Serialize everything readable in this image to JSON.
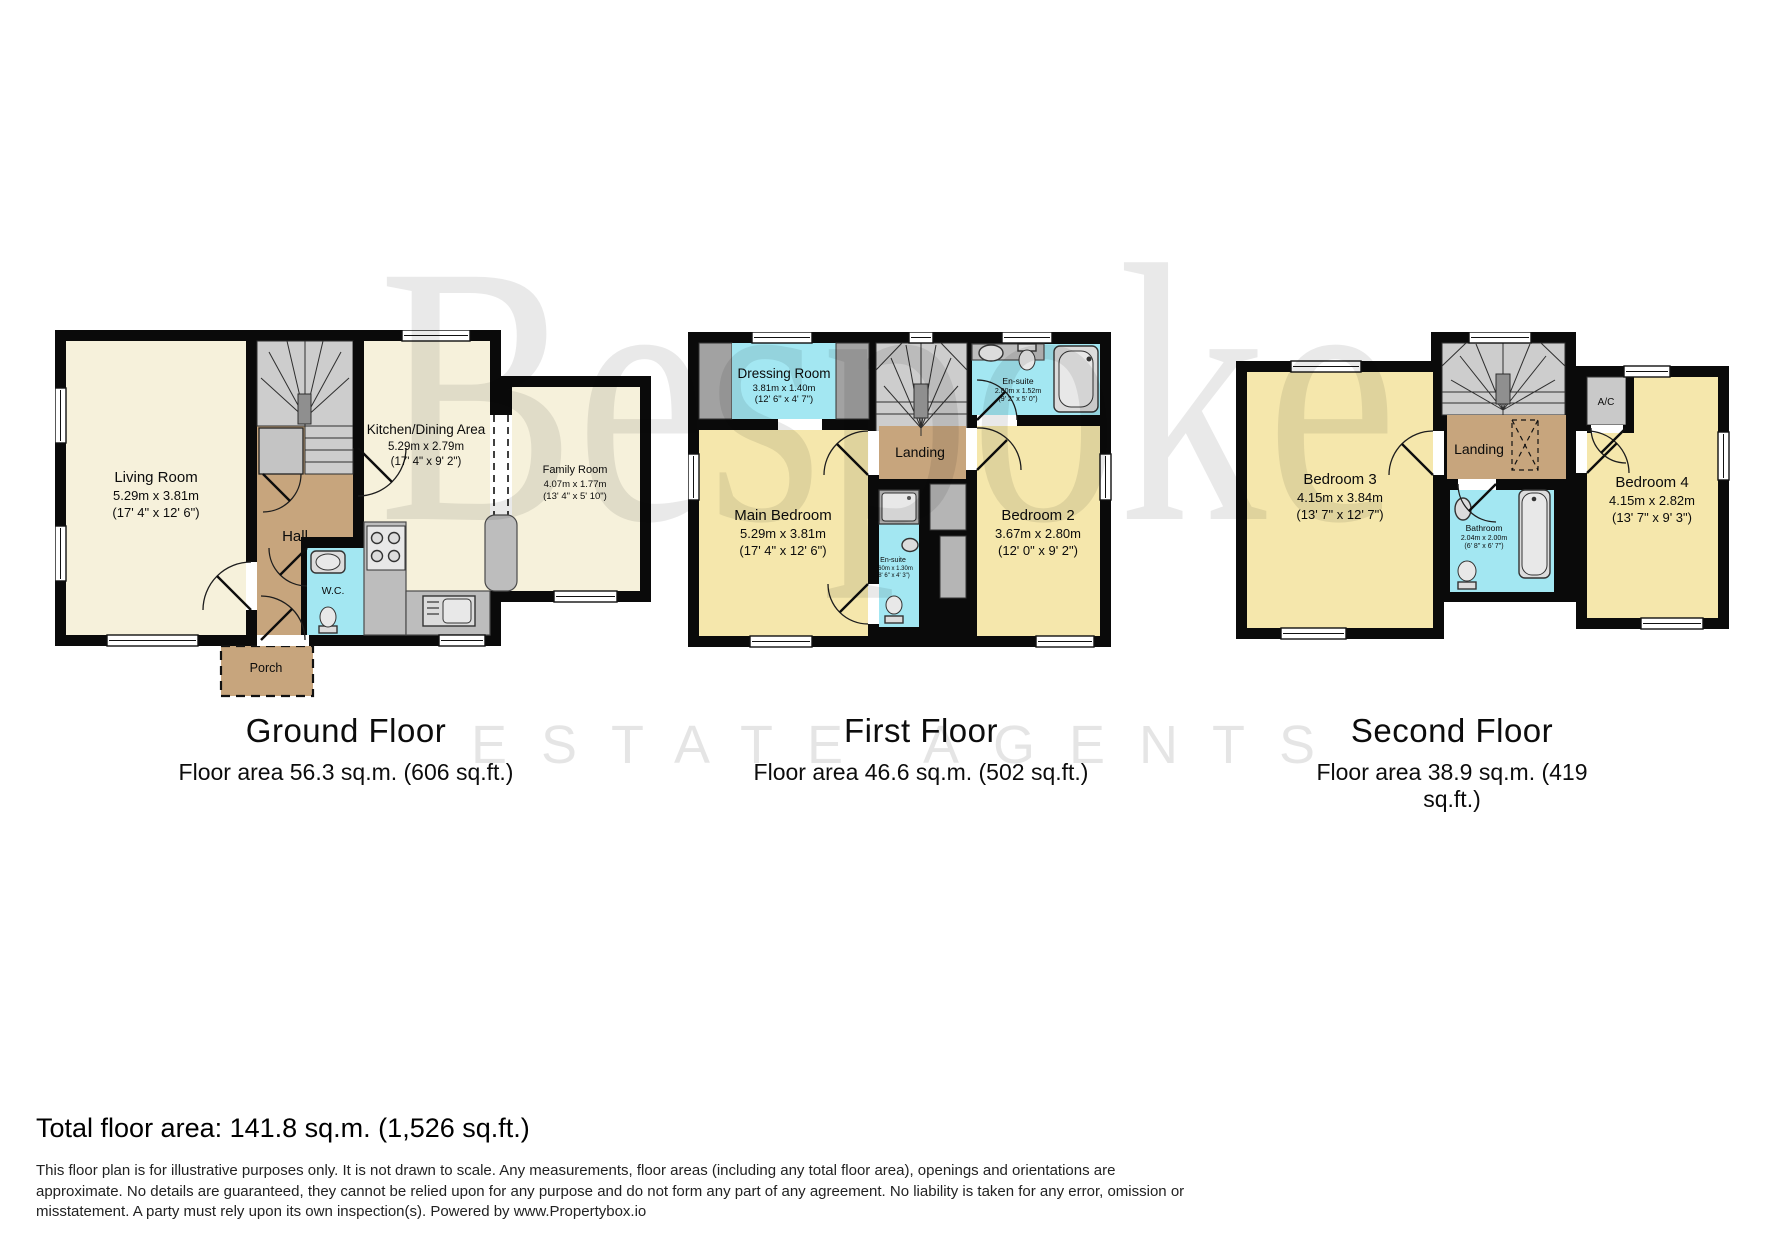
{
  "watermark": {
    "brand": "Bespoke",
    "tagline": "ESTATE AGENTS"
  },
  "colors": {
    "wall_black": "#0a0a0a",
    "room_cream": "#F6F1DB",
    "room_yellow": "#F5E7AC",
    "wet_cyan": "#A3E7F2",
    "circulation_tan": "#C7A57D",
    "stairs_gray": "#CDCDCD"
  },
  "floors": {
    "ground": {
      "title": "Ground Floor",
      "area_label": "Floor area 56.3 sq.m. (606 sq.ft.)",
      "rooms": {
        "living_room": {
          "name": "Living Room",
          "metric": "5.29m x 3.81m",
          "imperial": "(17' 4\" x 12' 6\")"
        },
        "kitchen_dining": {
          "name": "Kitchen/Dining Area",
          "metric": "5.29m x 2.79m",
          "imperial": "(17' 4\" x 9' 2\")"
        },
        "family_room": {
          "name": "Family Room",
          "metric": "4.07m x 1.77m",
          "imperial": "(13' 4\" x 5' 10\")"
        },
        "hall": {
          "name": "Hall"
        },
        "wc": {
          "name": "W.C."
        },
        "porch": {
          "name": "Porch"
        }
      }
    },
    "first": {
      "title": "First Floor",
      "area_label": "Floor area 46.6 sq.m. (502 sq.ft.)",
      "rooms": {
        "dressing_room": {
          "name": "Dressing Room",
          "metric": "3.81m x 1.40m",
          "imperial": "(12' 6\" x 4' 7\")"
        },
        "main_bedroom": {
          "name": "Main Bedroom",
          "metric": "5.29m x 3.81m",
          "imperial": "(17' 4\" x 12' 6\")"
        },
        "bedroom_2": {
          "name": "Bedroom 2",
          "metric": "3.67m x 2.80m",
          "imperial": "(12' 0\" x 9' 2\")"
        },
        "landing": {
          "name": "Landing"
        },
        "ensuite_top": {
          "name": "En-suite",
          "metric": "2.80m x 1.52m",
          "imperial": "(9' 2\" x 5' 0\")"
        },
        "ensuite_mid": {
          "name": "En-suite",
          "metric": "2.60m x 1.30m",
          "imperial": "(8' 6\" x 4' 3\")"
        }
      }
    },
    "second": {
      "title": "Second Floor",
      "area_label": "Floor area 38.9 sq.m. (419 sq.ft.)",
      "rooms": {
        "bedroom_3": {
          "name": "Bedroom 3",
          "metric": "4.15m x 3.84m",
          "imperial": "(13' 7\" x 12' 7\")"
        },
        "bedroom_4": {
          "name": "Bedroom 4",
          "metric": "4.15m x 2.82m",
          "imperial": "(13' 7\" x 9' 3\")"
        },
        "landing": {
          "name": "Landing"
        },
        "bathroom": {
          "name": "Bathroom",
          "metric": "2.04m x 2.00m",
          "imperial": "(6' 8\" x 6' 7\")"
        },
        "ac": {
          "name": "A/C"
        }
      }
    }
  },
  "summary": {
    "total_area": "Total floor area: 141.8 sq.m. (1,526 sq.ft.)"
  },
  "disclaimer": {
    "lines": [
      "This floor plan is for illustrative purposes only. It is not drawn to scale. Any measurements, floor areas (including any total floor area), openings and orientations are",
      "approximate. No details are guaranteed, they cannot be relied upon for any purpose and do not form any part of any agreement. No liability is taken for any error, omission or",
      "misstatement. A party must rely upon its own inspection(s). Powered by www.Propertybox.io"
    ]
  }
}
